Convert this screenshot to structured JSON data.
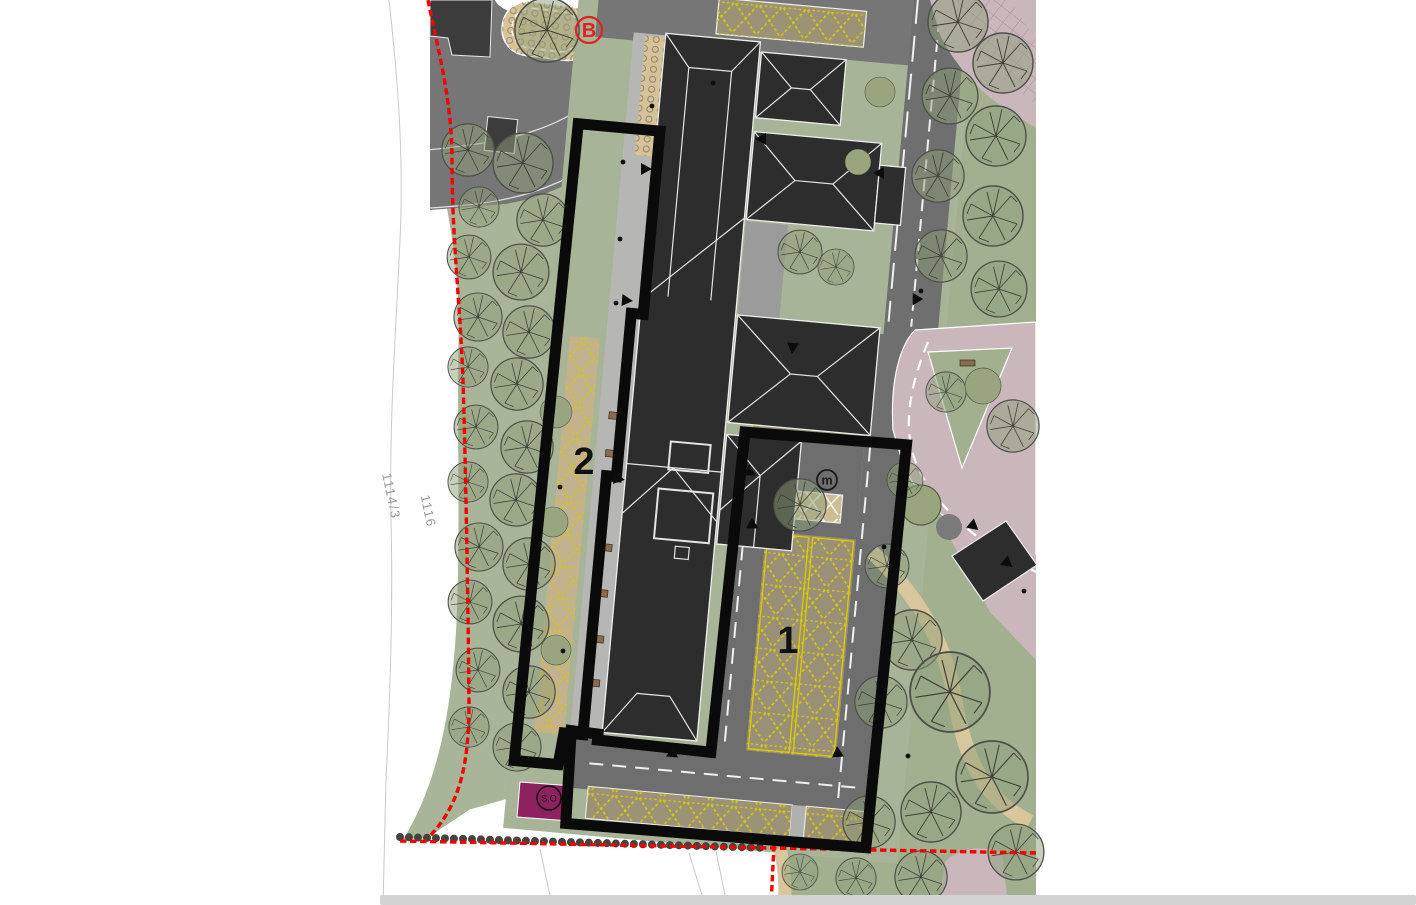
{
  "map": {
    "title": "site-plan",
    "area_labels": [
      {
        "number": "1",
        "description": "parking area highlight"
      },
      {
        "number": "2",
        "description": "promenade strip highlight"
      }
    ],
    "markers": {
      "bus_stop": "B",
      "m_marker": "m",
      "so_marker": "S.O"
    },
    "parcel_labels": [
      "1114/3",
      "1116"
    ],
    "colors": {
      "boundary_red": "#f40000",
      "highlight_outline": "#0a0a0a",
      "parking_yellow": "#d8c900",
      "landscape_green": "#a8b497",
      "road_gray": "#747474",
      "building_dark": "#2d2d2d",
      "pedestrian_pink": "#c9b7bc",
      "reserved_purple": "#8e2160",
      "sand_tan": "#d9c49a"
    }
  }
}
